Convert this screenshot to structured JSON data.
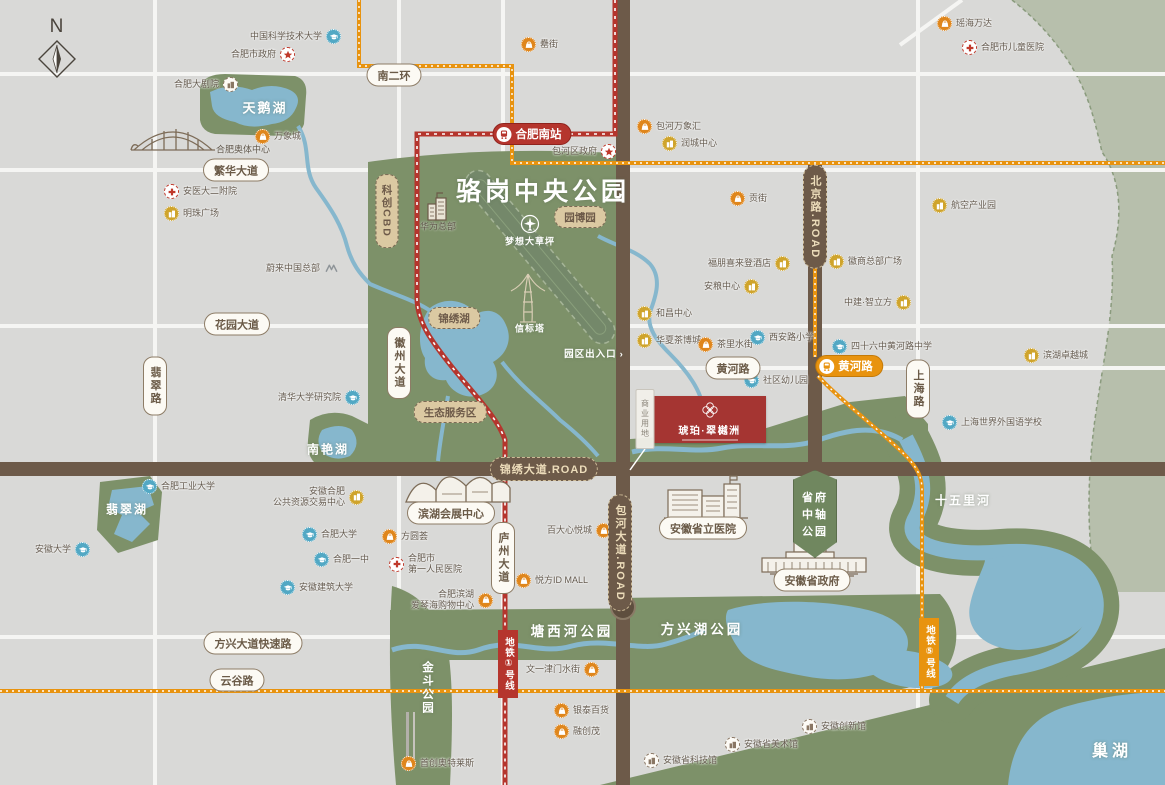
{
  "map": {
    "compass_label": "N",
    "park_title": "骆岗中央公园"
  },
  "colors": {
    "base_grey": "#d9d9d7",
    "road_white": "#f5f5f3",
    "park_green": "#7d9169",
    "pale_green": "#b7bfac",
    "water_blue": "#86b7cd",
    "road_brown": "#6d5a49",
    "accent_red": "#b5352d",
    "accent_orange": "#e8930f",
    "badge_tan": "#dbc9a2",
    "poi_orange": "#df861c",
    "poi_yellow": "#cfa42c",
    "poi_blue": "#52a8c4",
    "poi_red": "#c0392b",
    "poi_brown": "#8a7764",
    "project_red": "#a53532",
    "label_dark": "#645a4e"
  },
  "project": {
    "name": "琥珀·翠樾洲"
  },
  "shield": {
    "line1": "省府",
    "line2": "中轴",
    "line3": "公园"
  },
  "metro": {
    "stations": [
      {
        "id": "hefei-south-station",
        "label": "合肥南站",
        "x": 532,
        "y": 134,
        "color": "red"
      },
      {
        "id": "huanghe-road-station",
        "label": "黄河路",
        "x": 849,
        "y": 366,
        "color": "orange"
      }
    ],
    "line_badges": [
      {
        "id": "metro-line-1",
        "label": "地铁①号线",
        "x": 508,
        "y": 664,
        "color": "red"
      },
      {
        "id": "metro-line-5",
        "label": "地铁⑤号线",
        "x": 929,
        "y": 652,
        "color": "orange"
      }
    ]
  },
  "road_badges": [
    {
      "id": "south-2nd-ring",
      "label": "南二环",
      "x": 394,
      "y": 75,
      "style": "white"
    },
    {
      "id": "fanhua-avenue",
      "label": "繁华大道",
      "x": 236,
      "y": 170,
      "style": "white"
    },
    {
      "id": "huayuan-avenue",
      "label": "花园大道",
      "x": 237,
      "y": 324,
      "style": "white"
    },
    {
      "id": "feicui-road",
      "label": "翡翠路",
      "x": 155,
      "y": 386,
      "style": "white",
      "vertical": true
    },
    {
      "id": "huizhou-avenue",
      "label": "徽州大道",
      "x": 399,
      "y": 363,
      "style": "white",
      "vertical": true
    },
    {
      "id": "luzhou-avenue",
      "label": "庐州大道",
      "x": 503,
      "y": 558,
      "style": "white",
      "vertical": true
    },
    {
      "id": "shanghai-road",
      "label": "上海路",
      "x": 918,
      "y": 389,
      "style": "white",
      "vertical": true
    },
    {
      "id": "huanghe-road",
      "label": "黄河路",
      "x": 733,
      "y": 368,
      "style": "white"
    },
    {
      "id": "fangxing-expressway",
      "label": "方兴大道快速路",
      "x": 253,
      "y": 643,
      "style": "white"
    },
    {
      "id": "yungu-road",
      "label": "云谷路",
      "x": 237,
      "y": 680,
      "style": "white"
    },
    {
      "id": "kechuang-cbd",
      "label": "科创CBD",
      "x": 387,
      "y": 211,
      "style": "tan",
      "vertical": true
    },
    {
      "id": "yuanboyuan",
      "label": "园博园",
      "x": 580,
      "y": 217,
      "style": "tan"
    },
    {
      "id": "jinxiu-lake",
      "label": "锦绣湖",
      "x": 454,
      "y": 318,
      "style": "tan"
    },
    {
      "id": "eco-service-area",
      "label": "生态服务区",
      "x": 450,
      "y": 412,
      "style": "tan"
    },
    {
      "id": "jinxiu-avenue",
      "label": "锦绣大道.ROAD",
      "x": 544,
      "y": 469,
      "style": "dark"
    },
    {
      "id": "baohe-avenue",
      "label": "包河大道.ROAD",
      "x": 620,
      "y": 553,
      "style": "dark",
      "vertical": true
    },
    {
      "id": "beijing-road",
      "label": "北京路.ROAD",
      "x": 815,
      "y": 217,
      "style": "dark",
      "vertical": true
    },
    {
      "id": "provincial-hospital",
      "label": "安徽省立医院",
      "x": 703,
      "y": 528,
      "style": "white"
    },
    {
      "id": "provincial-government",
      "label": "安徽省政府",
      "x": 812,
      "y": 580,
      "style": "white"
    },
    {
      "id": "exhibition-center",
      "label": "滨湖会展中心",
      "x": 451,
      "y": 513,
      "style": "white"
    },
    {
      "id": "commercial-land",
      "label": "商业用地",
      "x": 645,
      "y": 419,
      "style": "land",
      "vertical": true
    }
  ],
  "area_labels": [
    {
      "id": "swan-lake",
      "label": "天鹅湖",
      "x": 265,
      "y": 107,
      "size": 13,
      "ls": 2
    },
    {
      "id": "luogang-park-title",
      "label": "骆岗中央公园",
      "x": 543,
      "y": 190,
      "size": 25,
      "ls": 4
    },
    {
      "id": "dream-lawn",
      "label": "梦想大草坪",
      "x": 530,
      "y": 241,
      "size": 9,
      "ls": 1
    },
    {
      "id": "beacon-tower",
      "label": "信标塔",
      "x": 530,
      "y": 328,
      "size": 9,
      "ls": 1
    },
    {
      "id": "park-entrance",
      "label": "园区出入口",
      "x": 594,
      "y": 353,
      "size": 9.5,
      "ls": 1,
      "arrow": true
    },
    {
      "id": "nanyan-lake",
      "label": "南艳湖",
      "x": 328,
      "y": 449,
      "size": 12,
      "ls": 2
    },
    {
      "id": "feicui-lake",
      "label": "翡翠湖",
      "x": 127,
      "y": 509,
      "size": 12,
      "ls": 2
    },
    {
      "id": "jindou-park",
      "label": "金斗公园",
      "x": 427,
      "y": 688,
      "size": 11.5,
      "ls": 2,
      "vertical": true
    },
    {
      "id": "tangxihe-park",
      "label": "塘西河公园",
      "x": 572,
      "y": 630,
      "size": 13.5,
      "ls": 3
    },
    {
      "id": "fangxinghu-park",
      "label": "方兴湖公园",
      "x": 702,
      "y": 628,
      "size": 13.5,
      "ls": 3
    },
    {
      "id": "shiwuli-river",
      "label": "十五里河",
      "x": 963,
      "y": 500,
      "size": 12,
      "ls": 2
    },
    {
      "id": "chao-lake",
      "label": "巢湖",
      "x": 1112,
      "y": 749,
      "size": 16,
      "ls": 4
    },
    {
      "id": "olympic-center",
      "label": "合肥奥体中心",
      "x": 243,
      "y": 149,
      "size": 9,
      "ls": 0,
      "dark": true
    },
    {
      "id": "huawei-hq",
      "label": "华为总部",
      "x": 438,
      "y": 226,
      "size": 9,
      "ls": 0,
      "dark": true
    }
  ],
  "pois": [
    {
      "id": "ustc",
      "type": "school",
      "label": "中国科学技术大学",
      "x": 333,
      "y": 37,
      "side": "left"
    },
    {
      "id": "hefei-city-gov",
      "type": "star",
      "label": "合肥市政府",
      "x": 287,
      "y": 55,
      "side": "left"
    },
    {
      "id": "leijie-street",
      "type": "bag",
      "label": "罍街",
      "x": 529,
      "y": 45,
      "side": "right"
    },
    {
      "id": "yaohai-wanda",
      "type": "bag",
      "label": "瑶海万达",
      "x": 945,
      "y": 24,
      "side": "right"
    },
    {
      "id": "children-hospital",
      "type": "cross",
      "label": "合肥市儿童医院",
      "x": 970,
      "y": 48,
      "side": "right"
    },
    {
      "id": "grand-theatre",
      "type": "museum",
      "label": "合肥大剧院",
      "x": 230,
      "y": 85,
      "side": "left"
    },
    {
      "id": "mixc-mall",
      "type": "bag",
      "label": "万象城",
      "x": 263,
      "y": 137,
      "side": "right"
    },
    {
      "id": "ba",
      "type": "bag",
      "label": "包河万象汇",
      "x": 645,
      "y": 127,
      "side": "right"
    },
    {
      "id": "runcheng-center",
      "type": "building",
      "label": "润城中心",
      "x": 670,
      "y": 144,
      "side": "right"
    },
    {
      "id": "baohe-district-gov",
      "type": "star",
      "label": "包河区政府",
      "x": 608,
      "y": 152,
      "side": "left"
    },
    {
      "id": "anyi-2nd-hospital",
      "type": "cross",
      "label": "安医大二附院",
      "x": 172,
      "y": 192,
      "side": "right"
    },
    {
      "id": "mingzhu-plaza",
      "type": "building",
      "label": "明珠广场",
      "x": 172,
      "y": 214,
      "side": "right"
    },
    {
      "id": "aviation-industry-park",
      "type": "building",
      "label": "航空产业园",
      "x": 940,
      "y": 206,
      "side": "right"
    },
    {
      "id": "gongjie-street",
      "type": "bag",
      "label": "贡街",
      "x": 738,
      "y": 199,
      "side": "right"
    },
    {
      "id": "four-points-hotel",
      "type": "building",
      "label": "福朋喜来登酒店",
      "x": 782,
      "y": 264,
      "side": "left"
    },
    {
      "id": "huishang-hq-plaza",
      "type": "building",
      "label": "徽商总部广场",
      "x": 837,
      "y": 262,
      "side": "right"
    },
    {
      "id": "anliang-center",
      "type": "building",
      "label": "安粮中心",
      "x": 751,
      "y": 287,
      "side": "left"
    },
    {
      "id": "zhongjian-cube",
      "type": "building",
      "label": "中建·智立方",
      "x": 903,
      "y": 303,
      "side": "left"
    },
    {
      "id": "hechang-center",
      "type": "building",
      "label": "和昌中心",
      "x": 645,
      "y": 314,
      "side": "right"
    },
    {
      "id": "huaxia-tea-expo-city",
      "type": "building",
      "label": "华夏茶博城",
      "x": 645,
      "y": 341,
      "side": "right"
    },
    {
      "id": "chali-water-street",
      "type": "bag",
      "label": "茶里水街",
      "x": 706,
      "y": 345,
      "side": "right"
    },
    {
      "id": "xianlu-primary-school",
      "type": "school",
      "label": "西安路小学",
      "x": 758,
      "y": 338,
      "side": "right"
    },
    {
      "id": "no46-huanghe-school",
      "type": "school",
      "label": "四十六中黄河路中学",
      "x": 840,
      "y": 347,
      "side": "right"
    },
    {
      "id": "community-kindergarten",
      "type": "school",
      "label": "社区幼儿园",
      "x": 752,
      "y": 381,
      "side": "right"
    },
    {
      "id": "binhu-excellence-city",
      "type": "building",
      "label": "滨湖卓越城",
      "x": 1032,
      "y": 356,
      "side": "right"
    },
    {
      "id": "shanghai-foreign-school",
      "type": "school",
      "label": "上海世界外国语学校",
      "x": 950,
      "y": 423,
      "side": "right"
    },
    {
      "id": "nio-china-hq",
      "type": "nio",
      "label": "蔚来中国总部",
      "x": 331,
      "y": 269,
      "side": "left"
    },
    {
      "id": "tsinghua-institute",
      "type": "school",
      "label": "清华大学研究院",
      "x": 352,
      "y": 398,
      "side": "left"
    },
    {
      "id": "hfut",
      "type": "school",
      "label": "合肥工业大学",
      "x": 150,
      "y": 487,
      "side": "right"
    },
    {
      "id": "anhui-university",
      "type": "school",
      "label": "安徽大学",
      "x": 82,
      "y": 550,
      "side": "left"
    },
    {
      "id": "public-resource-center",
      "type": "building",
      "lines": [
        "安徽合肥",
        "公共资源交易中心"
      ],
      "x": 356,
      "y": 494,
      "side": "left"
    },
    {
      "id": "hefei-university",
      "type": "school",
      "label": "合肥大学",
      "x": 310,
      "y": 535,
      "side": "right"
    },
    {
      "id": "hefei-no1-school",
      "type": "school",
      "label": "合肥一中",
      "x": 322,
      "y": 560,
      "side": "right"
    },
    {
      "id": "anhui-jianzhu-university",
      "type": "school",
      "label": "安徽建筑大学",
      "x": 288,
      "y": 588,
      "side": "right"
    },
    {
      "id": "fangyuanhui",
      "type": "bag",
      "label": "方圆荟",
      "x": 390,
      "y": 537,
      "side": "right"
    },
    {
      "id": "first-peoples-hospital",
      "type": "cross",
      "lines": [
        "合肥市",
        "第一人民医院"
      ],
      "x": 397,
      "y": 561,
      "side": "right"
    },
    {
      "id": "aegean-mall",
      "type": "bag",
      "lines": [
        "合肥滨湖",
        "爱琴海购物中心"
      ],
      "x": 485,
      "y": 597,
      "side": "left"
    },
    {
      "id": "yuefang-id-mall",
      "type": "bag",
      "label": "悦方ID MALL",
      "x": 524,
      "y": 581,
      "side": "right"
    },
    {
      "id": "baida-xinyue-mall",
      "type": "bag",
      "label": "百大心悦城",
      "x": 603,
      "y": 531,
      "side": "left"
    },
    {
      "id": "wenyi-water-street",
      "type": "bag",
      "label": "文一津门水街",
      "x": 591,
      "y": 670,
      "side": "left"
    },
    {
      "id": "yintai-department",
      "type": "bag",
      "label": "银泰百货",
      "x": 562,
      "y": 711,
      "side": "right"
    },
    {
      "id": "sunac-mall",
      "type": "bag",
      "label": "融创茂",
      "x": 562,
      "y": 732,
      "side": "right"
    },
    {
      "id": "shouchuang-outlets",
      "type": "bag",
      "label": "首创奥特莱斯",
      "x": 409,
      "y": 764,
      "side": "right"
    },
    {
      "id": "anhui-innovation-hall",
      "type": "museum",
      "label": "安徽创新馆",
      "x": 810,
      "y": 727,
      "side": "right"
    },
    {
      "id": "anhui-art-museum",
      "type": "museum",
      "label": "安徽省美术馆",
      "x": 733,
      "y": 745,
      "side": "right"
    },
    {
      "id": "anhui-sci-tech-museum",
      "type": "museum",
      "label": "安徽省科技馆",
      "x": 652,
      "y": 761,
      "side": "right"
    }
  ]
}
